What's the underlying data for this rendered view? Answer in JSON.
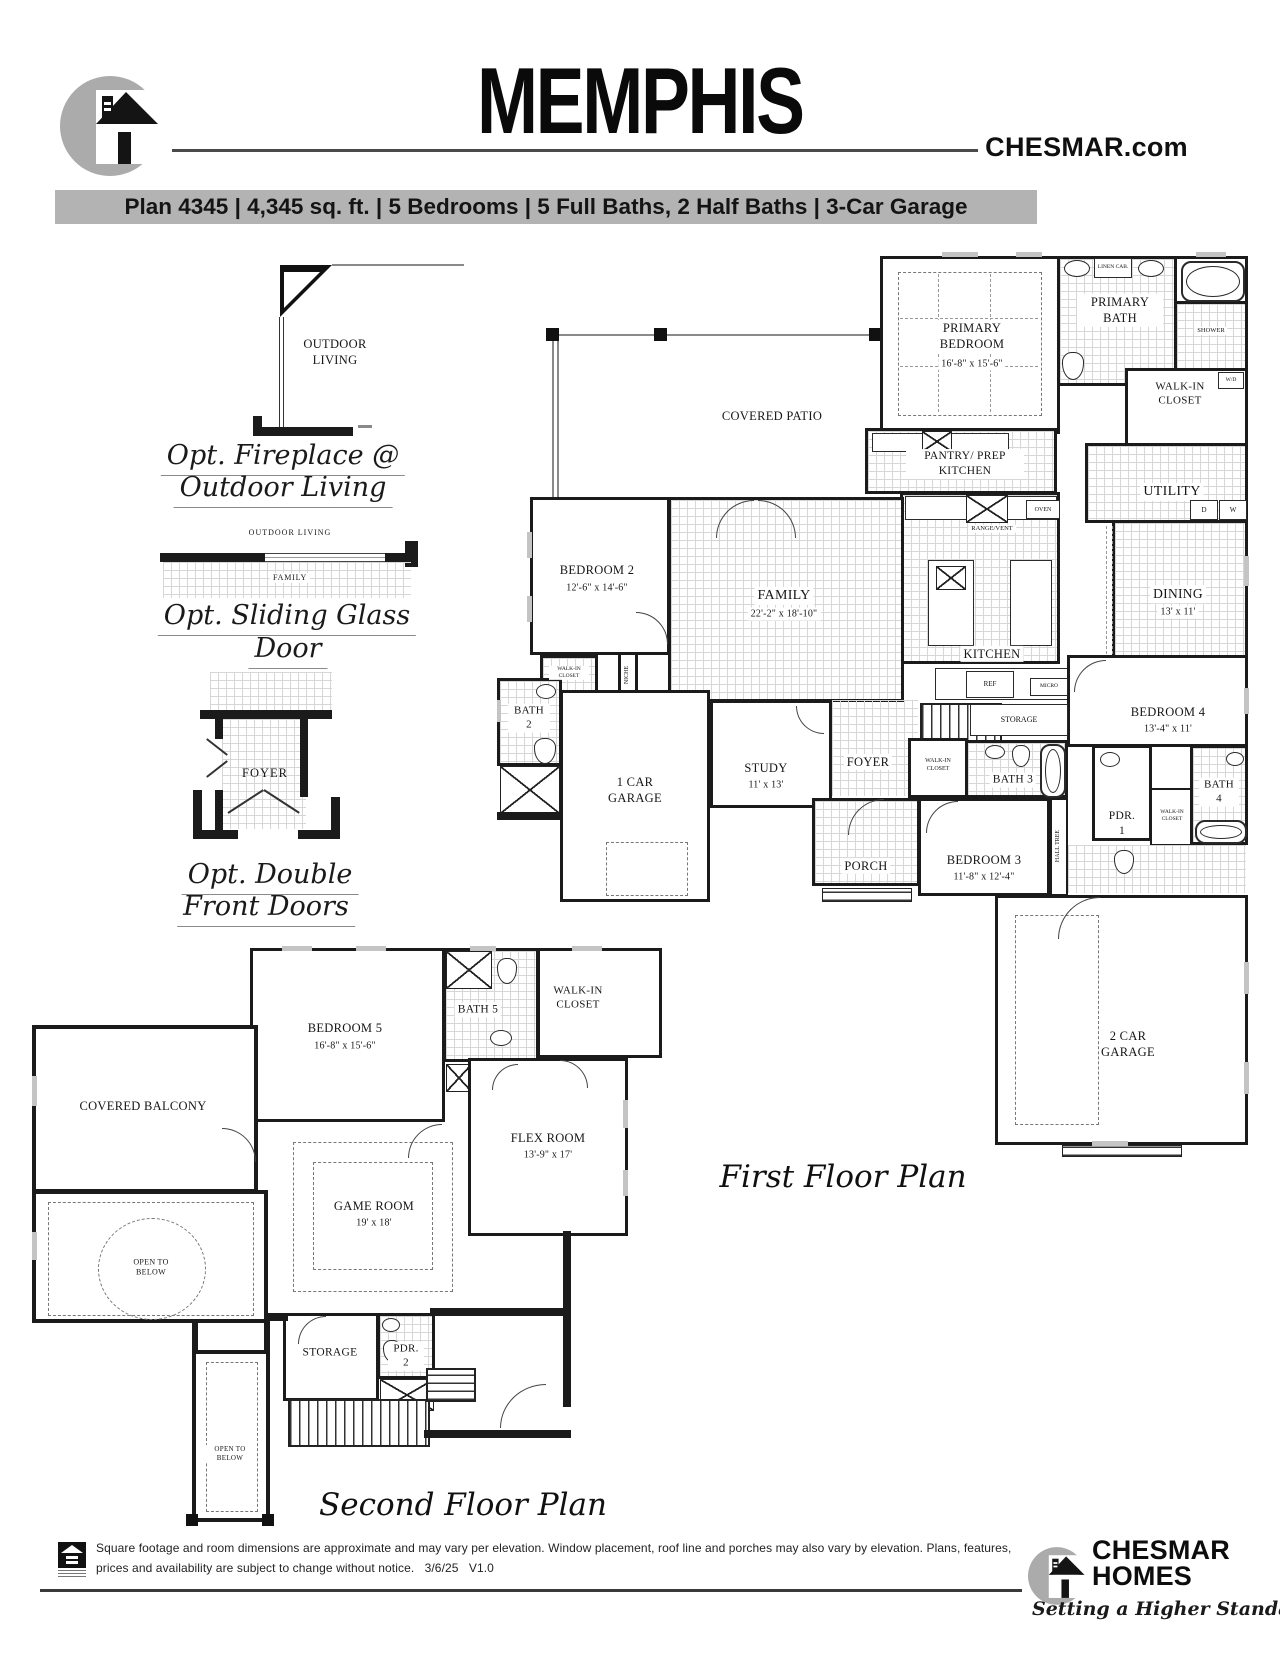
{
  "header": {
    "title": "MEMPHIS",
    "website": "CHESMAR.com",
    "plan_banner": "Plan 4345 | 4,345 sq. ft. | 5 Bedrooms | 5 Full Baths, 2 Half Baths | 3-Car Garage"
  },
  "options": [
    {
      "caption_line1": "Opt. Fireplace @",
      "caption_line2": "Outdoor Living",
      "diagram_label": "OUTDOOR LIVING"
    },
    {
      "caption_line1": "Opt. Sliding Glass",
      "caption_line2": "Door",
      "diagram_label": "OUTDOOR LIVING",
      "diagram_room": "FAMILY"
    },
    {
      "caption_line1": "Opt. Double",
      "caption_line2": "Front Doors",
      "diagram_room": "FOYER"
    }
  ],
  "first_floor": {
    "title": "First Floor Plan",
    "rooms": {
      "covered_patio": {
        "name": "COVERED PATIO"
      },
      "primary_bedroom": {
        "name": "PRIMARY BEDROOM",
        "dims": "16'-8\" x 15'-6\""
      },
      "primary_bath": {
        "name": "PRIMARY BATH"
      },
      "shower": {
        "name": "SHOWER"
      },
      "walkin_primary": {
        "name": "WALK-IN CLOSET"
      },
      "utility": {
        "name": "UTILITY"
      },
      "pantry": {
        "name": "PANTRY/ PREP KITCHEN"
      },
      "bedroom2": {
        "name": "BEDROOM 2",
        "dims": "12'-6\" x 14'-6\""
      },
      "family": {
        "name": "FAMILY",
        "dims": "22'-2\" x 18'-10\""
      },
      "kitchen": {
        "name": "KITCHEN"
      },
      "dining": {
        "name": "DINING",
        "dims": "13' x 11'"
      },
      "bedroom4": {
        "name": "BEDROOM 4",
        "dims": "13'-4\" x 11'"
      },
      "bath2": {
        "name": "BATH 2"
      },
      "garage1": {
        "name": "1 CAR GARAGE"
      },
      "study": {
        "name": "STUDY",
        "dims": "11' x 13'"
      },
      "foyer": {
        "name": "FOYER"
      },
      "bath3": {
        "name": "BATH 3"
      },
      "walkin_hall": {
        "name": "WALK-IN CLOSET"
      },
      "walkin_bed2": {
        "name": "WALK-IN CLOSET"
      },
      "porch": {
        "name": "PORCH"
      },
      "bedroom3": {
        "name": "BEDROOM 3",
        "dims": "11'-8\" x 12'-4\""
      },
      "pdr1": {
        "name": "PDR. 1"
      },
      "walkin_bed4": {
        "name": "WALK-IN CLOSET"
      },
      "bath4": {
        "name": "BATH 4"
      },
      "hall_tree": {
        "name": "HALL TREE"
      },
      "garage2": {
        "name": "2 CAR GARAGE"
      }
    },
    "fixtures": {
      "linen": "LINEN CAB.",
      "wd": "W/D",
      "d": "D",
      "w": "W",
      "oven": "OVEN",
      "range": "RANGE/VENT",
      "ref": "REF",
      "micro": "MICRO",
      "storage": "STORAGE",
      "niche": "NICHE"
    }
  },
  "second_floor": {
    "title": "Second Floor Plan",
    "rooms": {
      "bedroom5": {
        "name": "BEDROOM 5",
        "dims": "16'-8\" x 15'-6\""
      },
      "bath5": {
        "name": "BATH 5"
      },
      "walkin5": {
        "name": "WALK-IN CLOSET"
      },
      "covered_balcony": {
        "name": "COVERED BALCONY"
      },
      "flex": {
        "name": "FLEX ROOM",
        "dims": "13'-9\" x 17'"
      },
      "game": {
        "name": "GAME ROOM",
        "dims": "19' x 18'"
      },
      "open_below": {
        "name": "OPEN TO BELOW"
      },
      "storage": {
        "name": "STORAGE"
      },
      "pdr2": {
        "name": "PDR. 2"
      },
      "open_below_small": {
        "name": "OPEN TO BELOW"
      }
    }
  },
  "footer": {
    "disclaimer_line1": "Square footage and room dimensions are approximate and may vary per elevation. Window placement, roof line and porches may also vary by elevation. Plans, features,",
    "disclaimer_line2": "prices and availability are subject to change without notice.   3/6/25   V1.0",
    "brand_line1": "CHESMAR",
    "brand_line2": "HOMES",
    "tagline": "Setting a Higher Standard"
  },
  "icons": {
    "header_logo": "chesmar-house-logo",
    "footer_logo": "chesmar-house-logo",
    "eho": "equal-housing-opportunity-logo"
  }
}
